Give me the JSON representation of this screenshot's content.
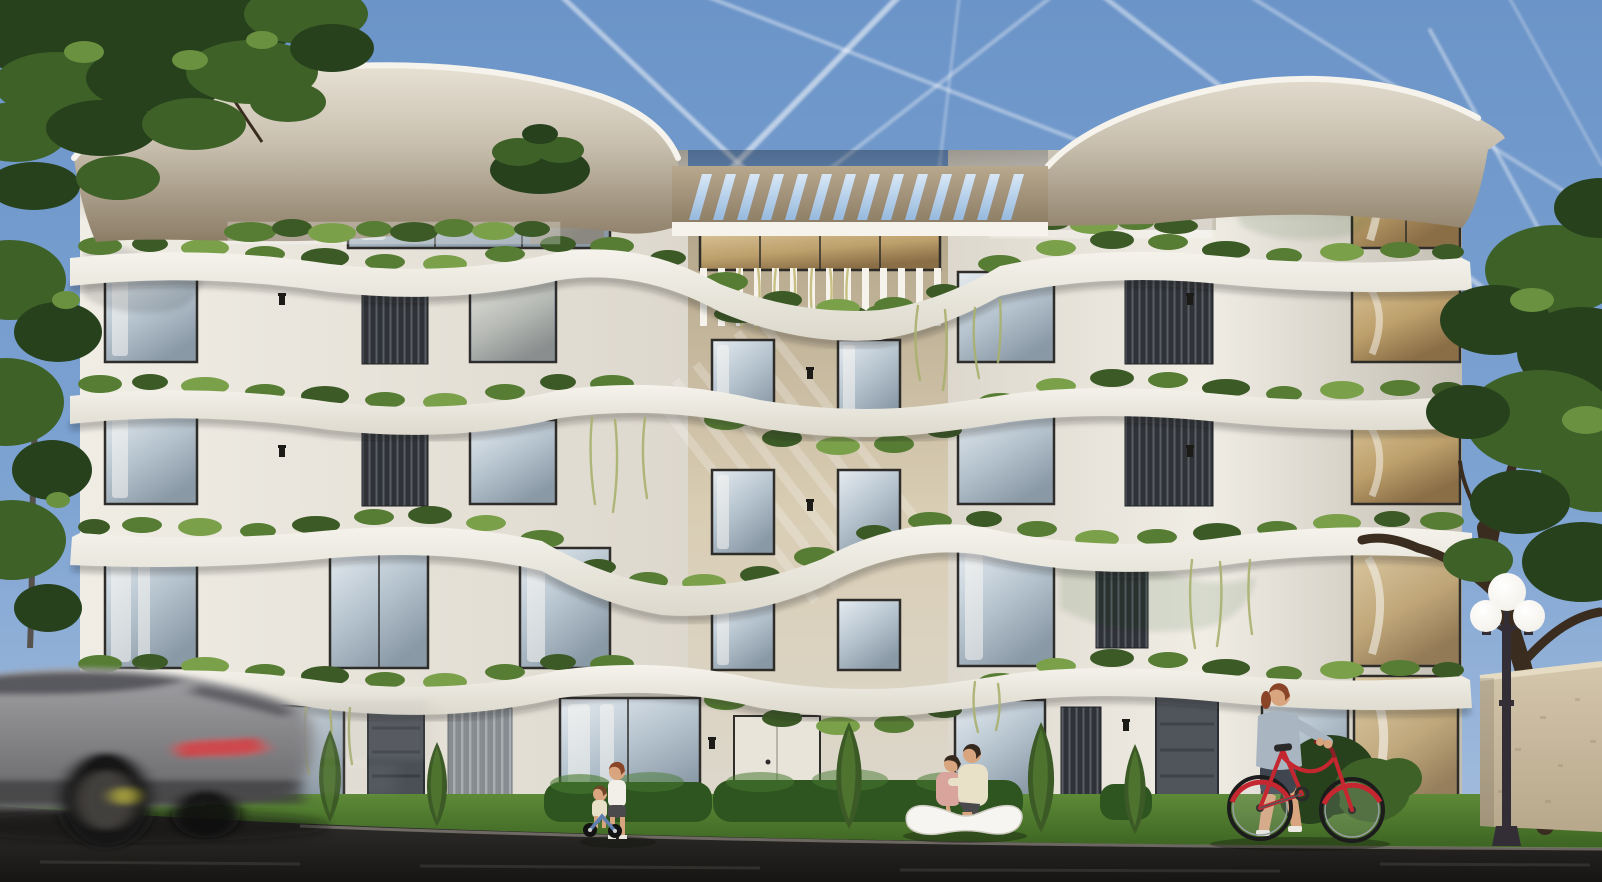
{
  "scene": {
    "type": "architectural-exterior-render",
    "setting": "modern five-storey apartment building with curved white balcony slabs, planted terraces, street scene in daylight",
    "floors": 5,
    "slab_bands": 4,
    "pergola_slats": 14,
    "lamp_globes": 3,
    "people": [
      "standing-child",
      "toddler-on-balance-bike",
      "seated-woman-on-bench",
      "seated-man-on-bench",
      "woman-pushing-bicycle"
    ],
    "vehicles": [
      "motion-blurred-gray-car",
      "red-bicycle"
    ],
    "vegetation": [
      "left-canopy-tree",
      "left-side-tree",
      "right-street-tree",
      "roof-opening-tree",
      "terrace-planters",
      "hanging-vines",
      "hedges",
      "conical-shrubs",
      "grass-verge"
    ],
    "street_furniture": [
      "white-sculptural-bench",
      "triple-globe-street-lamp",
      "beige-boundary-wall"
    ],
    "sky_features": [
      "crossing-contrails"
    ]
  },
  "palette": {
    "sky_top": "#6b94c8",
    "sky_mid": "#7da3d2",
    "sky_bottom": "#a9c0de",
    "contrail": "#ffffff",
    "facade_light": "#f0ede5",
    "facade_mid": "#ddd8cd",
    "facade_shadow": "#c3beb2",
    "slab_light": "#f5f3ec",
    "slab_mid": "#dcd8cc",
    "roof_face": "#e7e1d4",
    "roof_mid": "#c8bfae",
    "roof_underside": "#8c7d66",
    "pergola_light": "#b7a88e",
    "pergola_dark": "#8b7c64",
    "slot_light": "#d8e7f7",
    "slot_dark": "#97bade",
    "center_wall_light": "#d9cdb4",
    "center_wall": "#b2a488",
    "glass_light": "#e6ecf1",
    "glass_mid": "#b4c2cd",
    "glass_dark": "#8a99a6",
    "amber_light": "#dcc79d",
    "amber_mid": "#bda06c",
    "amber_dark": "#8a6e46",
    "frame_dark": "#2e2d2a",
    "curtain": "#f7f6f2",
    "slat_dark": "#2f3236",
    "slat_line": "#5a5f66",
    "louver_bg": "#878c90",
    "louver_line": "#a9aeb3",
    "greenery_dark": "#3c5a26",
    "greenery_mid": "#567d33",
    "greenery_light": "#7ba04a",
    "vine": "#a8b06e",
    "vine_gold": "#c6bd7e",
    "grass_light": "#5d8a37",
    "grass_dark": "#3a6121",
    "hedge": "#2e5520",
    "hedge_light": "#477931",
    "road_top": "#343230",
    "road_dark": "#161514",
    "road_streak": "#474440",
    "curb": "#a8a196",
    "car_light": "#a2a2a5",
    "car_dark": "#646467",
    "car_glass": "#4e4e54",
    "taillight": "#c23a3c",
    "wheel_dark": "#121212",
    "brake_glow": "#c9c23e",
    "bench_white": "#f6f5f1",
    "bench_shadow": "#b9b6ae",
    "skin": "#d8a57f",
    "hair_red": "#8a4528",
    "hair_dark": "#35281d",
    "hair_brown": "#6e4526",
    "shirt_white": "#f2efe8",
    "shorts_dark": "#4a4a4c",
    "shirt_pink": "#d8a49c",
    "shirt_cream": "#e9e0c8",
    "jacket_blue": "#a9b5c1",
    "bike_red": "#c52730",
    "trike_blue": "#5f7fae",
    "lamp_post": "#332e36",
    "lamp_globe": "#f2efe7",
    "wall_beige": "#d4c6ab",
    "wall_beige_dark": "#b7a88c",
    "trunk_dark": "#3a2d20",
    "tree_dark": "#27411d",
    "tree_mid": "#3e6128",
    "tree_bright": "#699140"
  }
}
